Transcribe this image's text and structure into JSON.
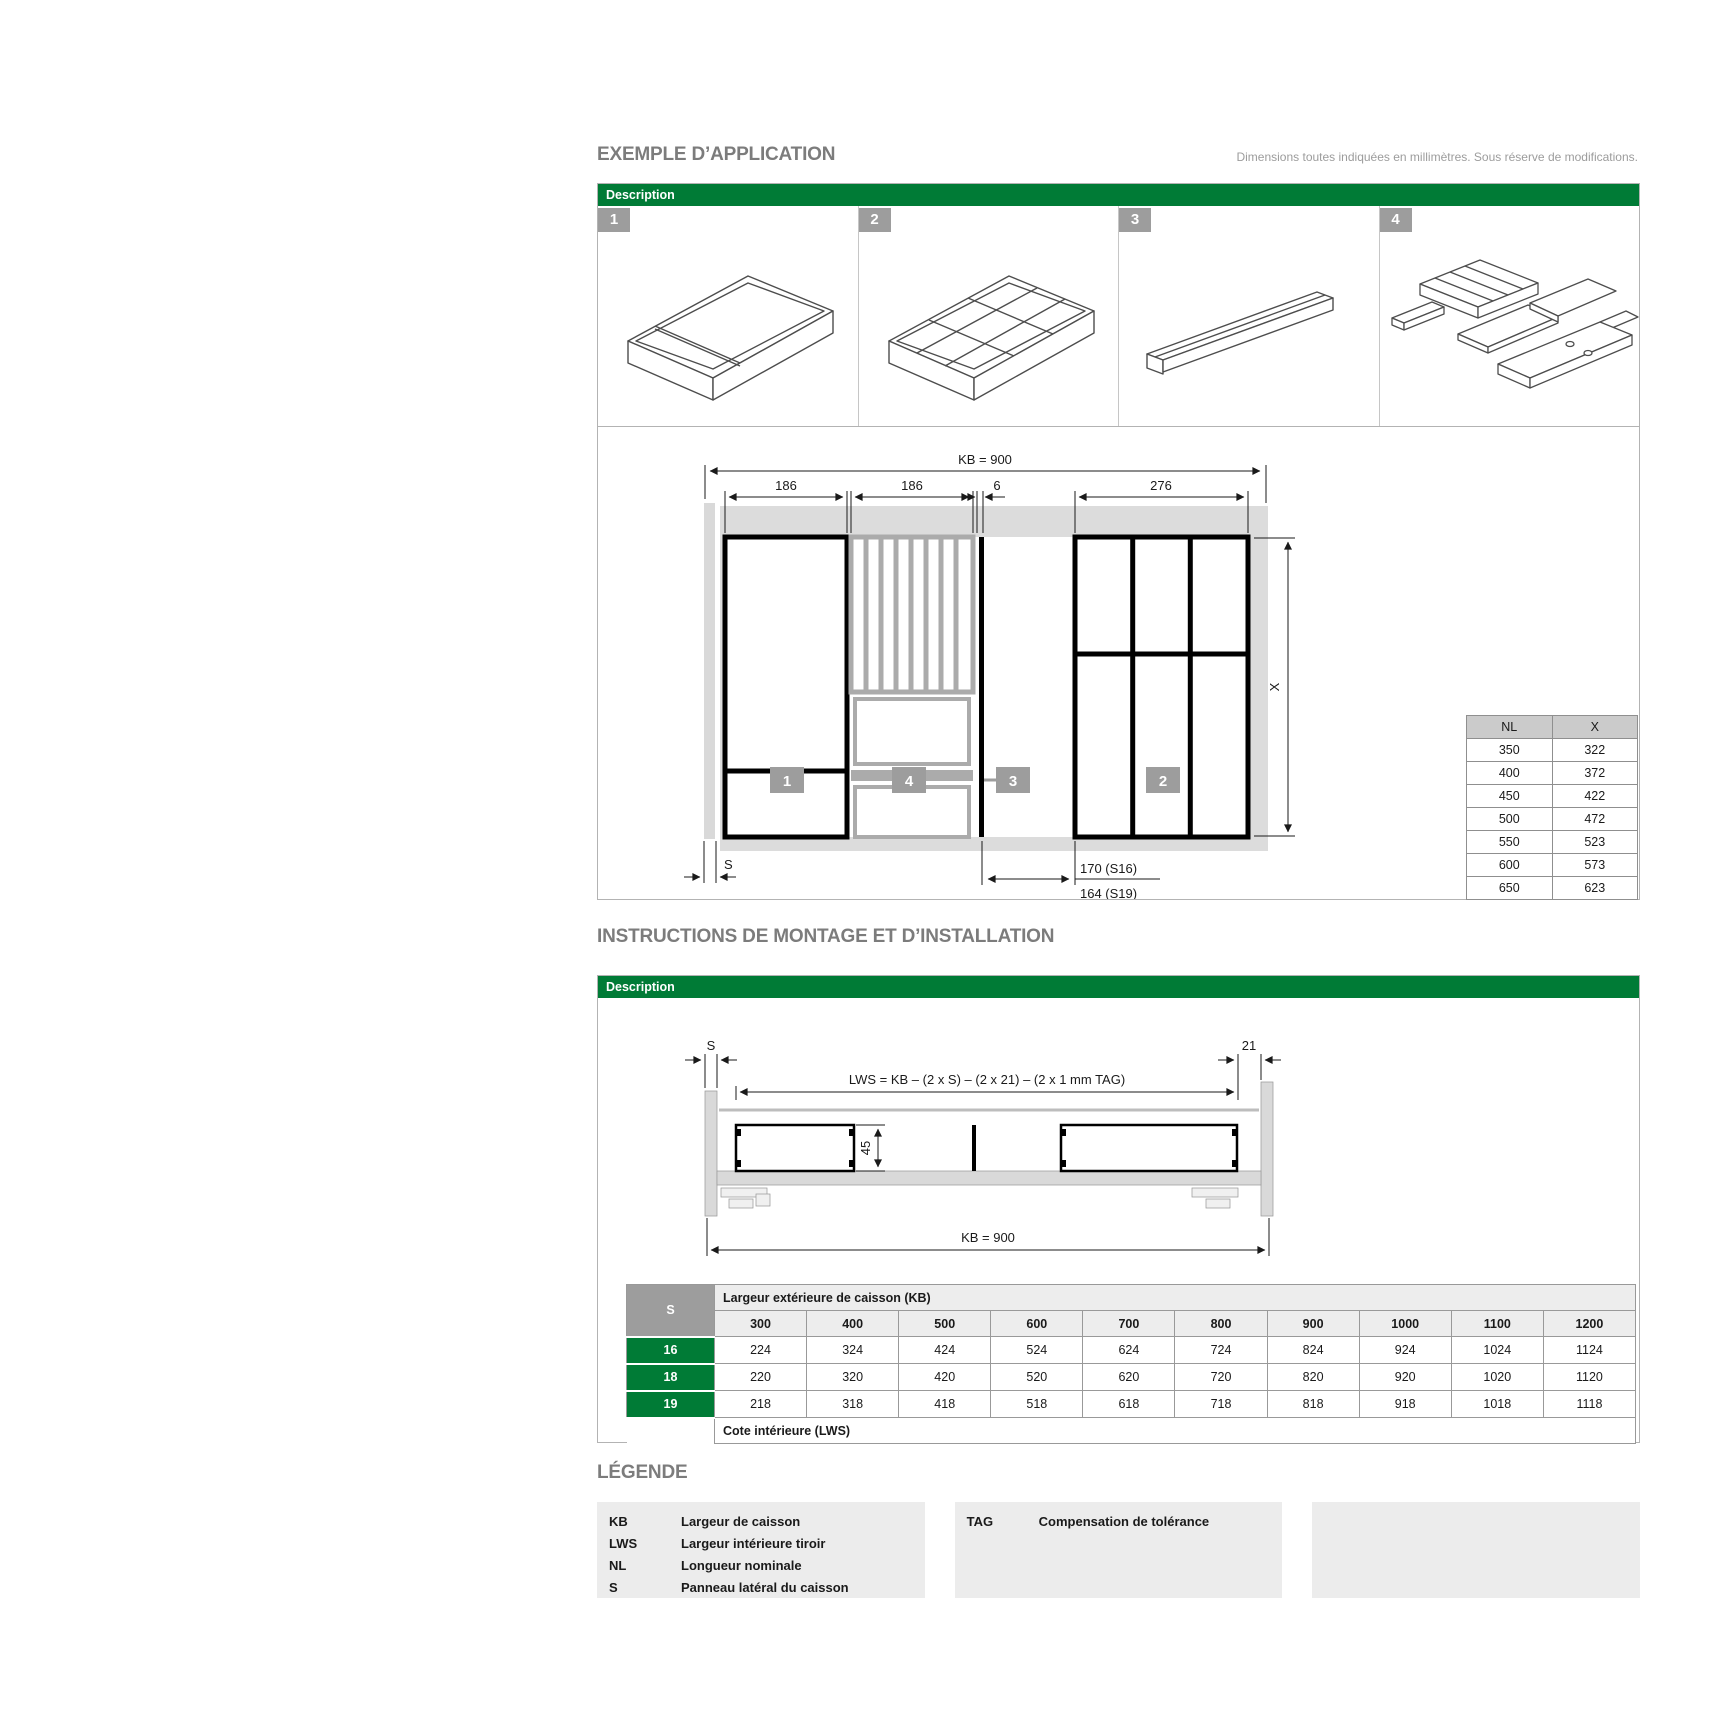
{
  "header": {
    "title1": "EXEMPLE D’APPLICATION",
    "subtitle": "Dimensions toutes indiquées en millimètres. Sous réserve de modifications.",
    "title2": "INSTRUCTIONS DE MONTAGE ET D’INSTALLATION",
    "legend_title": "LÉGENDE",
    "description_label": "Description"
  },
  "plan": {
    "badge1": "1",
    "badge2": "2",
    "badge3": "3",
    "badge4": "4",
    "dim_kb": "KB = 900",
    "dim_186a": "186",
    "dim_186b": "186",
    "dim_6": "6",
    "dim_276": "276",
    "dim_x": "X",
    "dim_s": "S",
    "dim_s16": "170 (S16)",
    "dim_s19": "164 (S19)"
  },
  "nlx": {
    "headers": [
      "NL",
      "X"
    ],
    "rows": [
      [
        "350",
        "322"
      ],
      [
        "400",
        "372"
      ],
      [
        "450",
        "422"
      ],
      [
        "500",
        "472"
      ],
      [
        "550",
        "523"
      ],
      [
        "600",
        "573"
      ],
      [
        "650",
        "623"
      ]
    ]
  },
  "xsec": {
    "dim_s": "S",
    "dim_21": "21",
    "formula": "LWS = KB – (2 x S) – (2 x 21) – (2 x 1 mm TAG)",
    "dim_45": "45",
    "dim_kb": "KB = 900"
  },
  "kbtable": {
    "s_header": "S",
    "kb_header": "Largeur extérieure de caisson (KB)",
    "cols": [
      "300",
      "400",
      "500",
      "600",
      "700",
      "800",
      "900",
      "1000",
      "1100",
      "1200"
    ],
    "rows": [
      {
        "s": "16",
        "v": [
          "224",
          "324",
          "424",
          "524",
          "624",
          "724",
          "824",
          "924",
          "1024",
          "1124"
        ]
      },
      {
        "s": "18",
        "v": [
          "220",
          "320",
          "420",
          "520",
          "620",
          "720",
          "820",
          "920",
          "1020",
          "1120"
        ]
      },
      {
        "s": "19",
        "v": [
          "218",
          "318",
          "418",
          "518",
          "618",
          "718",
          "818",
          "918",
          "1018",
          "1118"
        ]
      }
    ],
    "footer": "Cote intérieure (LWS)"
  },
  "legend": {
    "items1": [
      {
        "k": "KB",
        "v": "Largeur de caisson"
      },
      {
        "k": "LWS",
        "v": "Largeur intérieure tiroir"
      },
      {
        "k": "NL",
        "v": "Longueur nominale"
      },
      {
        "k": "S",
        "v": "Panneau latéral du caisson"
      }
    ],
    "items2": [
      {
        "k": "TAG",
        "v": "Compensation de tolérance"
      }
    ]
  },
  "colors": {
    "accent_green": "#007B36",
    "badge_gray": "#9d9d9d",
    "table_header_gray": "#cbcbcb",
    "light_header_gray": "#ededed",
    "legend_panel_gray": "#ececec",
    "drawing_gray": "#d9d9d9"
  }
}
